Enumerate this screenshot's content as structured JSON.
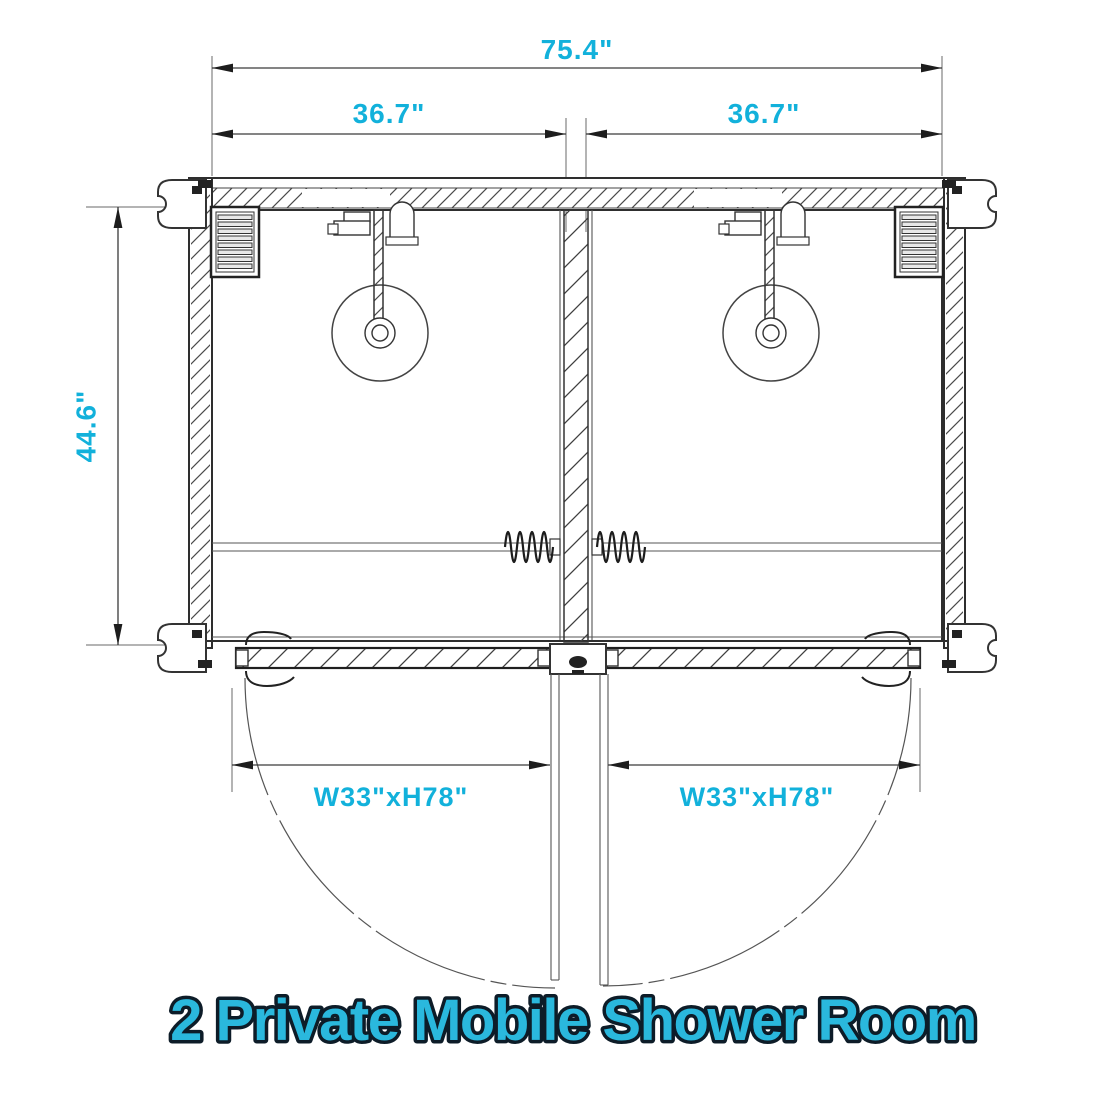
{
  "title": {
    "text": "2 Private Mobile Shower Room"
  },
  "colors": {
    "accent": "#12b1db",
    "title_fill": "#2ab8dd",
    "title_outline": "#0d1c28",
    "drawing_line": "#333333"
  },
  "dimensions": {
    "overall_width": "75.4\"",
    "left_room_width": "36.7\"",
    "right_room_width": "36.7\"",
    "depth": "44.6\""
  },
  "doors": {
    "left": {
      "label": "W33\"xH78\""
    },
    "right": {
      "label": "W33\"xH78\""
    }
  }
}
